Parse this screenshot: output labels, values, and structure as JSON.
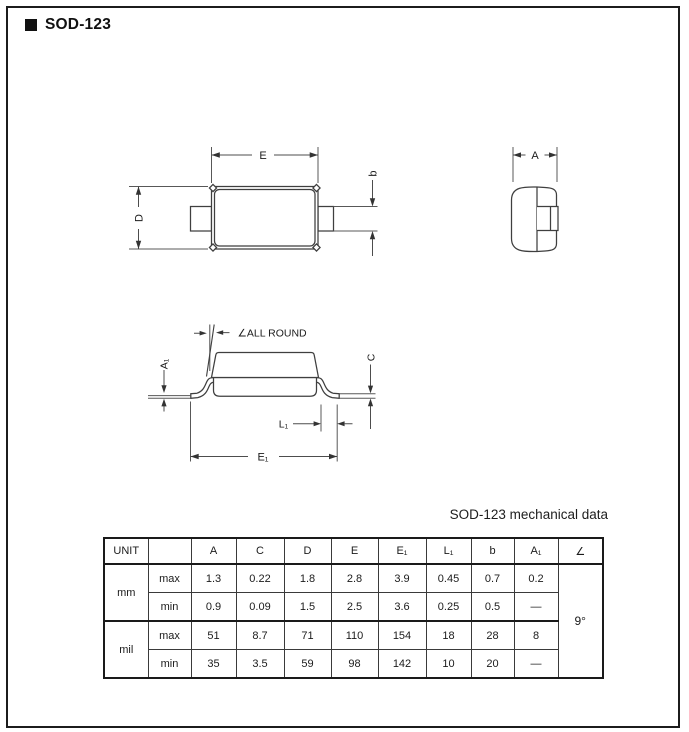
{
  "page": {
    "title": "SOD-123",
    "line_color": "#3f3f3f",
    "text_color": "#1b1b1b"
  },
  "drawings": {
    "top_view": {
      "labels": {
        "e": "E",
        "d": "D",
        "b": "b"
      }
    },
    "end_view": {
      "labels": {
        "a": "A"
      }
    },
    "side_view": {
      "labels": {
        "all_round": "∠ALL ROUND",
        "a1": "A₁",
        "c": "C",
        "l1": "L₁",
        "e1": "E₁"
      }
    }
  },
  "table": {
    "heading": "SOD-123 mechanical data",
    "columns": [
      "UNIT",
      "",
      "A",
      "C",
      "D",
      "E",
      "E₁",
      "L₁",
      "b",
      "A₁",
      "∠"
    ],
    "rows": [
      {
        "unit": "mm",
        "limit": "max",
        "values": [
          "1.3",
          "0.22",
          "1.8",
          "2.8",
          "3.9",
          "0.45",
          "0.7",
          "0.2"
        ]
      },
      {
        "unit": "mm",
        "limit": "min",
        "values": [
          "0.9",
          "0.09",
          "1.5",
          "2.5",
          "3.6",
          "0.25",
          "0.5",
          "—"
        ]
      },
      {
        "unit": "mil",
        "limit": "max",
        "values": [
          "51",
          "8.7",
          "71",
          "110",
          "154",
          "18",
          "28",
          "8"
        ]
      },
      {
        "unit": "mil",
        "limit": "min",
        "values": [
          "35",
          "3.5",
          "59",
          "98",
          "142",
          "10",
          "20",
          "—"
        ]
      }
    ],
    "angle_value": "9°"
  }
}
